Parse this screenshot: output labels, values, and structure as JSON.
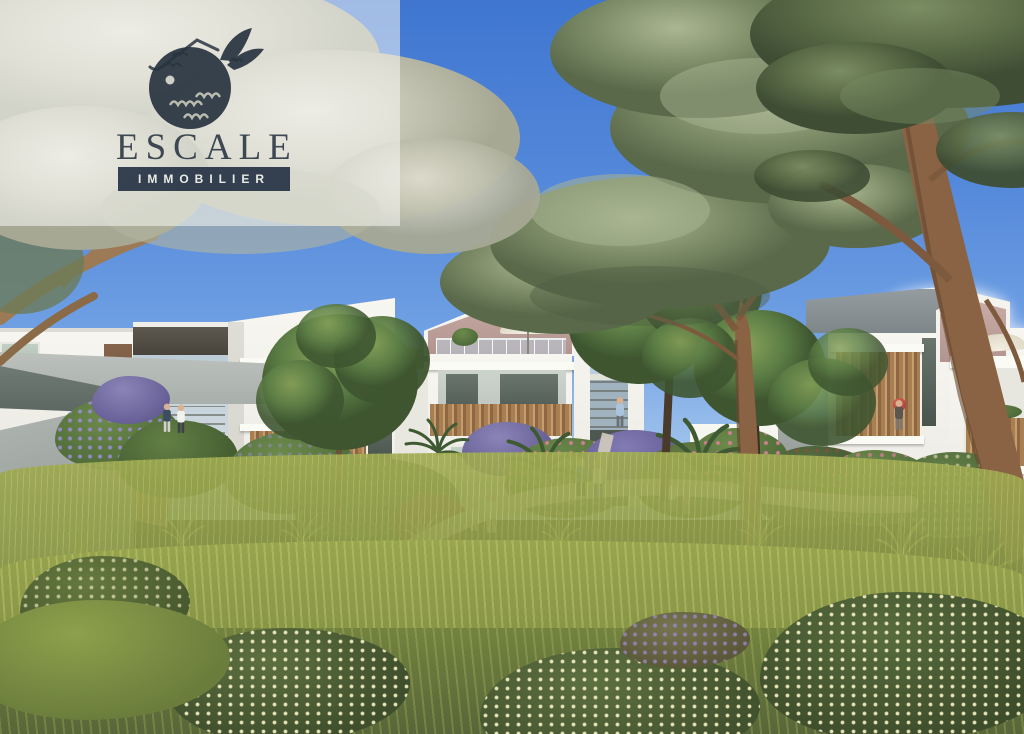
{
  "image_type": "architectural-rendering-photo",
  "logo": {
    "name": "ESCALE",
    "subtitle": "IMMOBILIER",
    "icons": [
      "whale-icon",
      "house-roof-icon",
      "birds-icon",
      "waves-icon"
    ]
  },
  "palette": {
    "sky_top": "#3f76d0",
    "sky_horizon": "#c6dcf4",
    "overlay_white": "rgba(252,252,250,0.52)",
    "logo_navy": "#27333f",
    "banner_navy": "#1c2a3e",
    "building_white": "#f2f1ec",
    "gable_pink": "#c2a49e",
    "roof_grey": "#868d90",
    "wood_slats": "#b08457",
    "concrete_grey": "#9aa19d",
    "pine_foliage_silver": "#8e9b7a",
    "pine_foliage_dark": "#5a6b47",
    "trunk_brown": "#8a6344",
    "meadow_green": "#8a9848",
    "path_beige": "#d2ccbd",
    "lavender": "#988ccc",
    "flower_pink": "#db8096",
    "flower_cream": "#eeeabe",
    "accent_red": "#c23b3b"
  }
}
